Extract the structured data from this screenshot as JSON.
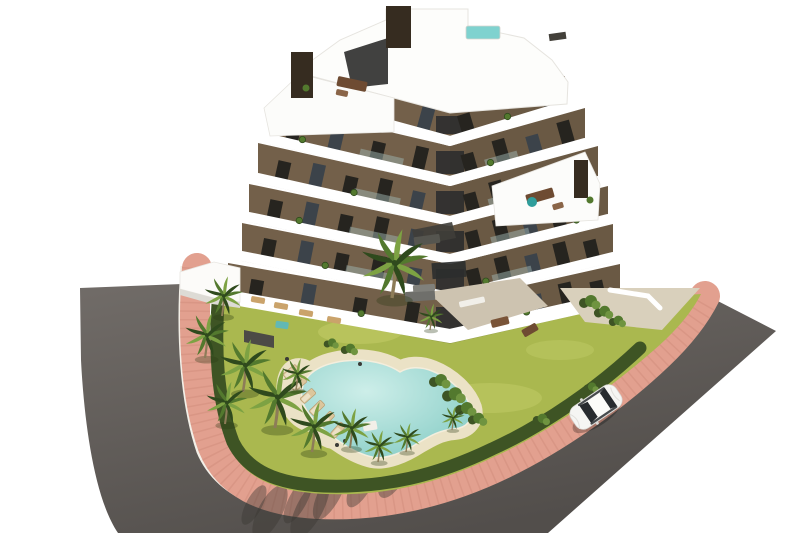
{
  "scene": {
    "description": "aerial 3d architectural render of a modern v-shaped apartment building with rooftop pool, lagoon swimming pool, palm garden, pink paved sidewalk, asphalt road and one white car",
    "background": "#ffffff",
    "colors": {
      "road_light": "#6f6a66",
      "road_dark": "#535049",
      "sidewalk": "#e2a08f",
      "sidewalk_tex": "#c98372",
      "curb": "#f2efe7",
      "lawn": "#aab84f",
      "lawn_light": "#c2cc68",
      "hedge": "#3e5424",
      "palm_mid": "#53792e",
      "palm_light": "#7da243",
      "palm_dark": "#2f4a1d",
      "trunk": "#8d7c58",
      "pool_water": "#8fd0c9",
      "pool_water_light": "#cdeee9",
      "pool_deck": "#ebe2c6",
      "gravel": "#b7b0a0",
      "facade": "#73604a",
      "slab_white": "#ffffff",
      "slab_shadow": "#cbc9c3",
      "window": "#26241f",
      "glass": "#3c434a",
      "chimney": "#362c20",
      "roof_pool": "#7fd2cf",
      "car_body": "#f5f5f3",
      "car_glass": "#272b2f",
      "shadow": "#3a3733",
      "terrace_pavers": "#cdc3b0",
      "pavers_right": "#d9d0bc"
    },
    "building": {
      "floor_count": 6,
      "corner_x": 450,
      "floors": [
        {
          "l": [
            300,
            100
          ],
          "a": [
            450,
            141
          ],
          "r": [
            565,
            106
          ],
          "h": 30,
          "wl": 2,
          "wr": 2
        },
        {
          "l": [
            270,
            139
          ],
          "a": [
            450,
            181
          ],
          "r": [
            585,
            143
          ],
          "h": 35,
          "wl": 4,
          "wr": 4
        },
        {
          "l": [
            258,
            178
          ],
          "a": [
            450,
            221
          ],
          "r": [
            598,
            181
          ],
          "h": 35,
          "wl": 5,
          "wr": 5
        },
        {
          "l": [
            249,
            217
          ],
          "a": [
            450,
            259
          ],
          "r": [
            608,
            219
          ],
          "h": 33,
          "wl": 5,
          "wr": 5
        },
        {
          "l": [
            242,
            256
          ],
          "a": [
            450,
            297
          ],
          "r": [
            613,
            257
          ],
          "h": 33,
          "wl": 5,
          "wr": 5
        },
        {
          "l": [
            228,
            297
          ],
          "a": [
            450,
            336
          ],
          "r": [
            620,
            298
          ],
          "h": 34,
          "wl": 4,
          "wr": 5
        }
      ],
      "planters": [
        {
          "f": 0,
          "w": "L",
          "t": 0.5
        },
        {
          "f": 0,
          "w": "R",
          "t": 0.5
        },
        {
          "f": 1,
          "w": "L",
          "t": 0.18
        },
        {
          "f": 1,
          "w": "R",
          "t": 0.3
        },
        {
          "f": 2,
          "w": "L",
          "t": 0.5
        },
        {
          "f": 2,
          "w": "R",
          "t": 0.65
        },
        {
          "f": 3,
          "w": "L",
          "t": 0.25
        },
        {
          "f": 3,
          "w": "R",
          "t": 0.8
        },
        {
          "f": 4,
          "w": "L",
          "t": 0.4
        },
        {
          "f": 4,
          "w": "R",
          "t": 0.22
        },
        {
          "f": 5,
          "w": "L",
          "t": 0.6
        },
        {
          "f": 5,
          "w": "R",
          "t": 0.45
        }
      ],
      "chimney_count": 3,
      "has_rooftop_pool": true
    },
    "furniture": [
      [
        352,
        84,
        30,
        10,
        12,
        "#6e4b32"
      ],
      [
        342,
        93,
        12,
        6,
        12,
        "#8a6548"
      ],
      [
        540,
        196,
        28,
        10,
        -16,
        "#6e4b32"
      ],
      [
        558,
        206,
        11,
        6,
        -16,
        "#8a6548"
      ],
      [
        427,
        240,
        26,
        9,
        -8,
        "#55554f"
      ],
      [
        420,
        296,
        30,
        10,
        -4,
        "#6f6f6b"
      ],
      [
        424,
        288,
        22,
        7,
        -4,
        "#80807b"
      ],
      [
        472,
        302,
        26,
        6,
        -12,
        "#f1efe9"
      ],
      [
        500,
        322,
        18,
        8,
        -14,
        "#7a5438"
      ],
      [
        530,
        330,
        16,
        8,
        -30,
        "#6e4b32"
      ],
      [
        258,
        300,
        14,
        6,
        10,
        "#caa36b"
      ],
      [
        281,
        306,
        14,
        6,
        10,
        "#caa36b"
      ],
      [
        306,
        313,
        14,
        6,
        10,
        "#caa36b"
      ],
      [
        334,
        320,
        14,
        6,
        10,
        "#caa36b"
      ],
      [
        282,
        325,
        13,
        7,
        8,
        "#62b8b4"
      ],
      [
        370,
        426,
        14,
        9,
        -10,
        "#f2efe8"
      ]
    ],
    "accent_dots": [
      [
        532,
        202,
        5,
        "#2f9e9b"
      ],
      [
        306,
        88,
        3.5,
        "#53792e"
      ],
      [
        590,
        200,
        3.5,
        "#53792e"
      ],
      [
        287,
        359,
        2,
        "#3a3a36"
      ],
      [
        360,
        364,
        2,
        "#3a3a36"
      ],
      [
        337,
        445,
        2,
        "#3a3a36"
      ],
      [
        345,
        441,
        2,
        "#3a3a36"
      ]
    ],
    "palms": [
      [
        222,
        316,
        0.75
      ],
      [
        205,
        358,
        0.85
      ],
      [
        243,
        392,
        1.0
      ],
      [
        225,
        424,
        0.8
      ],
      [
        275,
        428,
        1.15
      ],
      [
        312,
        452,
        0.95
      ],
      [
        350,
        448,
        0.75
      ],
      [
        296,
        390,
        0.6
      ],
      [
        378,
        462,
        0.6
      ],
      [
        406,
        452,
        0.55
      ],
      [
        392,
        298,
        1.3
      ],
      [
        430,
        330,
        0.5
      ],
      [
        452,
        430,
        0.45
      ]
    ],
    "bushes": [
      [
        438,
        382,
        1.0
      ],
      [
        452,
        396,
        1.1
      ],
      [
        464,
        410,
        1.0
      ],
      [
        476,
        420,
        0.9
      ],
      [
        588,
        303,
        1.0
      ],
      [
        602,
        313,
        0.9
      ],
      [
        616,
        322,
        0.8
      ],
      [
        348,
        350,
        0.8
      ],
      [
        330,
        344,
        0.7
      ],
      [
        540,
        420,
        0.8
      ],
      [
        590,
        388,
        0.7
      ]
    ],
    "loungers": [
      [
        291,
        372,
        -40
      ],
      [
        299,
        384,
        -40
      ],
      [
        308,
        396,
        -42
      ],
      [
        317,
        408,
        -44
      ],
      [
        327,
        419,
        -46
      ],
      [
        338,
        430,
        -48
      ]
    ],
    "tree_shadows": [
      [
        298,
        500,
        9,
        26
      ],
      [
        330,
        493,
        11,
        30
      ],
      [
        362,
        483,
        10,
        27
      ],
      [
        396,
        470,
        12,
        31
      ],
      [
        430,
        456,
        10,
        26
      ],
      [
        463,
        443,
        11,
        27
      ],
      [
        495,
        429,
        9,
        23
      ],
      [
        527,
        414,
        10,
        25
      ],
      [
        558,
        399,
        8,
        20
      ],
      [
        588,
        383,
        8,
        18
      ],
      [
        614,
        368,
        7,
        16
      ],
      [
        254,
        505,
        8,
        22
      ],
      [
        270,
        512,
        12,
        30
      ],
      [
        310,
        508,
        13,
        34
      ]
    ],
    "car": {
      "x": 596,
      "y": 407,
      "rot": -34,
      "type": "white-hatchback"
    }
  }
}
